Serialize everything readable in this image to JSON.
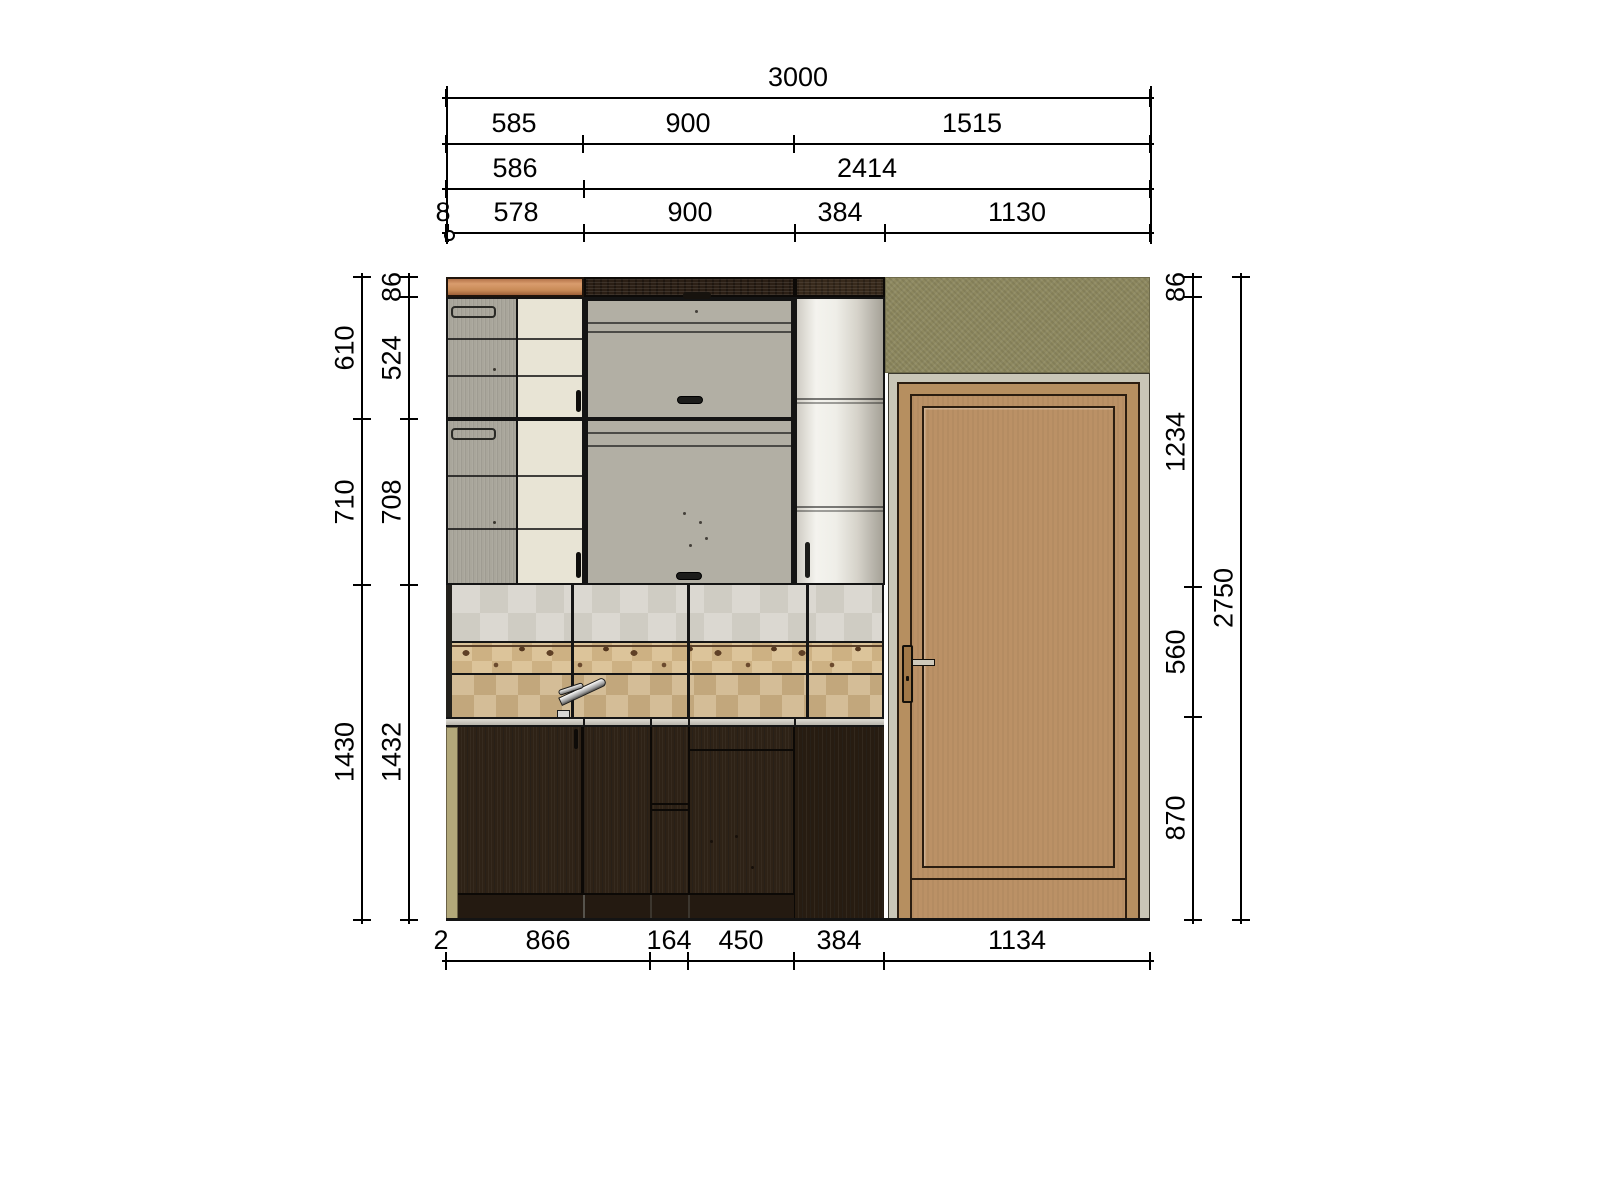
{
  "meta": {
    "title": "Kitchen wall elevation drawing with cabinets, tiled backsplash and entrance door",
    "drawing_type": "cad-elevation"
  },
  "palette": {
    "background": "#ffffff",
    "dimension_line": "#000000",
    "orange_strip": "#c98a5c",
    "walnut_strip": "#2b1f15",
    "olive_wall": "#8e8960",
    "grey_door": "#a9a69b",
    "cream_door": "#e8e4d5",
    "metallic_cabinet": "#d8d5cc",
    "tile_light": "#d9d6cf",
    "tile_mid": "#d9bd8f",
    "tile_spot": "#5f4026",
    "tile_lower": "#d2bb94",
    "counter": "#c9c6bd",
    "base_cabinet": "#2e2216",
    "side_panel": "#b2a87a",
    "door_frame_grey": "#c9c6b7",
    "door_wood": "#bb9166"
  },
  "dims": {
    "h": [
      {
        "y": 97,
        "x1": 446,
        "x2": 1150,
        "ticks": [
          446,
          1150
        ],
        "labels": [
          {
            "t": "3000",
            "x": 798
          }
        ]
      },
      {
        "y": 143,
        "x1": 446,
        "x2": 1150,
        "ticks": [
          446,
          583,
          794,
          1150
        ],
        "labels": [
          {
            "t": "585",
            "x": 514
          },
          {
            "t": "900",
            "x": 688
          },
          {
            "t": "1515",
            "x": 972
          }
        ]
      },
      {
        "y": 188,
        "x1": 446,
        "x2": 1150,
        "ticks": [
          446,
          584,
          1150
        ],
        "labels": [
          {
            "t": "586",
            "x": 515
          },
          {
            "t": "2414",
            "x": 867
          }
        ]
      },
      {
        "y": 232,
        "x1": 446,
        "x2": 1150,
        "ticks": [
          446,
          448,
          584,
          795,
          885,
          1150
        ],
        "circles": [
          448
        ],
        "labels": [
          {
            "t": "8",
            "x": 443
          },
          {
            "t": "578",
            "x": 516
          },
          {
            "t": "900",
            "x": 690
          },
          {
            "t": "384",
            "x": 840
          },
          {
            "t": "1130",
            "x": 1017
          }
        ]
      },
      {
        "y": 960,
        "x1": 446,
        "x2": 1150,
        "ticks": [
          446,
          650,
          688,
          794,
          884,
          1150
        ],
        "labels": [
          {
            "t": "2",
            "x": 441
          },
          {
            "t": "866",
            "x": 548
          },
          {
            "t": "164",
            "x": 669
          },
          {
            "t": "450",
            "x": 741
          },
          {
            "t": "384",
            "x": 839
          },
          {
            "t": "1134",
            "x": 1017
          }
        ]
      }
    ],
    "v": [
      {
        "x": 361,
        "y1": 277,
        "y2": 920,
        "ticks": [
          277,
          419,
          585,
          920
        ],
        "labels": [
          {
            "t": "610",
            "y": 348
          },
          {
            "t": "710",
            "y": 502
          },
          {
            "t": "1430",
            "y": 752
          }
        ]
      },
      {
        "x": 408,
        "y1": 277,
        "y2": 920,
        "ticks": [
          277,
          297,
          419,
          585,
          920
        ],
        "labels": [
          {
            "t": "86",
            "y": 287
          },
          {
            "t": "524",
            "y": 358
          },
          {
            "t": "708",
            "y": 502
          },
          {
            "t": "1432",
            "y": 752
          }
        ]
      },
      {
        "x": 1192,
        "y1": 277,
        "y2": 920,
        "ticks": [
          277,
          297,
          587,
          717,
          920
        ],
        "labels": [
          {
            "t": "86",
            "y": 287
          },
          {
            "t": "1234",
            "y": 442
          },
          {
            "t": "560",
            "y": 652
          },
          {
            "t": "870",
            "y": 818
          }
        ]
      },
      {
        "x": 1240,
        "y1": 277,
        "y2": 920,
        "ticks": [
          277,
          920
        ],
        "labels": [
          {
            "t": "2750",
            "y": 598
          }
        ]
      }
    ],
    "ext": [
      {
        "x": 446,
        "y1": 86,
        "y2": 244
      },
      {
        "x": 1150,
        "y1": 86,
        "y2": 244
      }
    ]
  }
}
